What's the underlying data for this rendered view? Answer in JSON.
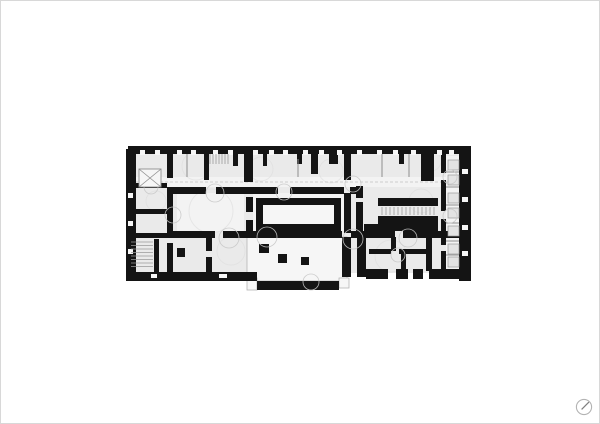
{
  "page": {
    "background": "#ffffff",
    "border_color": "#d8d8d8"
  },
  "compass_icon": {
    "ring_color": "#b3b3b3",
    "needle_color": "#7d7d7d"
  },
  "plan": {
    "colors": {
      "wall": "#141414",
      "base": "#eaeaea",
      "hall": "#f3f3f3",
      "cut": "#f6f6f6",
      "outline": "#b5b5b5",
      "partition": "#8f8f8f",
      "tread": "#9a9a9a",
      "fixture_fill": "#e3e3e3",
      "fixture_stroke": "#999999",
      "arc": "#c8c8c8",
      "texture": "#dcdcdc",
      "dash": "#c0c0c0"
    },
    "base_rects": [
      [
        133,
        152,
        327,
        120,
        "base"
      ],
      [
        133,
        176,
        327,
        10,
        "hall"
      ],
      [
        176,
        192,
        67,
        38,
        "hall"
      ],
      [
        252,
        192,
        92,
        38,
        "hall"
      ],
      [
        445,
        155,
        14,
        113,
        "hall"
      ]
    ],
    "outlined_rooms": [
      [
        246,
        236,
        100,
        44
      ],
      [
        246,
        277,
        10,
        12
      ],
      [
        338,
        277,
        10,
        10
      ]
    ],
    "walls": [
      [
        127,
        145,
        343,
        8
      ],
      [
        125,
        148,
        10,
        132
      ],
      [
        458,
        145,
        12,
        135
      ],
      [
        125,
        271,
        131,
        9
      ],
      [
        256,
        280,
        82,
        9
      ],
      [
        365,
        268,
        22,
        10
      ],
      [
        395,
        268,
        12,
        10
      ],
      [
        412,
        268,
        10,
        10
      ],
      [
        428,
        268,
        30,
        10
      ],
      [
        341,
        236,
        9,
        40
      ],
      [
        356,
        236,
        9,
        40
      ],
      [
        166,
        153,
        6,
        24
      ],
      [
        166,
        186,
        6,
        46
      ],
      [
        166,
        242,
        6,
        29
      ],
      [
        203,
        153,
        5,
        26
      ],
      [
        243,
        150,
        9,
        31
      ],
      [
        310,
        153,
        7,
        20
      ],
      [
        328,
        148,
        9,
        15
      ],
      [
        343,
        153,
        7,
        26
      ],
      [
        343,
        192,
        7,
        40
      ],
      [
        355,
        185,
        7,
        12
      ],
      [
        355,
        201,
        7,
        31
      ],
      [
        420,
        153,
        13,
        27
      ],
      [
        440,
        153,
        5,
        19
      ],
      [
        440,
        179,
        5,
        31
      ],
      [
        440,
        218,
        5,
        26
      ],
      [
        440,
        250,
        5,
        18
      ],
      [
        205,
        237,
        6,
        13
      ],
      [
        205,
        256,
        6,
        15
      ],
      [
        390,
        236,
        5,
        14
      ],
      [
        400,
        250,
        5,
        21
      ],
      [
        425,
        236,
        6,
        34
      ],
      [
        172,
        186,
        33,
        7
      ],
      [
        215,
        186,
        62,
        7
      ],
      [
        289,
        186,
        54,
        7
      ],
      [
        349,
        186,
        13,
        7
      ],
      [
        166,
        230,
        48,
        7
      ],
      [
        222,
        230,
        119,
        7
      ],
      [
        350,
        230,
        44,
        7
      ],
      [
        402,
        230,
        56,
        7
      ],
      [
        255,
        197,
        85,
        33
      ],
      [
        245,
        196,
        7,
        15
      ],
      [
        245,
        219,
        7,
        13
      ],
      [
        377,
        197,
        60,
        8
      ],
      [
        377,
        215,
        60,
        8
      ],
      [
        388,
        223,
        49,
        7
      ],
      [
        363,
        223,
        26,
        9
      ],
      [
        368,
        248,
        22,
        5
      ],
      [
        398,
        248,
        27,
        5
      ],
      [
        135,
        182,
        31,
        5
      ],
      [
        135,
        208,
        31,
        5
      ],
      [
        131,
        232,
        35,
        5
      ],
      [
        153,
        238,
        5,
        33
      ],
      [
        176,
        247,
        8,
        9
      ],
      [
        258,
        243,
        10,
        9
      ],
      [
        232,
        153,
        5,
        12
      ],
      [
        262,
        153,
        4,
        12
      ],
      [
        296,
        153,
        5,
        10
      ],
      [
        398,
        153,
        5,
        10
      ]
    ],
    "white_cuts": [
      [
        262,
        204,
        71,
        19
      ],
      [
        139,
        149,
        5,
        5
      ],
      [
        154,
        149,
        5,
        5
      ],
      [
        176,
        149,
        5,
        5
      ],
      [
        190,
        149,
        5,
        5
      ],
      [
        212,
        149,
        5,
        5
      ],
      [
        227,
        149,
        5,
        5
      ],
      [
        252,
        149,
        5,
        5
      ],
      [
        268,
        149,
        5,
        5
      ],
      [
        282,
        149,
        5,
        5
      ],
      [
        302,
        149,
        5,
        5
      ],
      [
        318,
        149,
        5,
        5
      ],
      [
        336,
        149,
        5,
        5
      ],
      [
        356,
        149,
        5,
        5
      ],
      [
        376,
        149,
        5,
        5
      ],
      [
        392,
        149,
        5,
        5
      ],
      [
        410,
        149,
        5,
        5
      ],
      [
        436,
        149,
        5,
        5
      ],
      [
        448,
        149,
        5,
        5
      ],
      [
        461,
        168,
        6,
        5
      ],
      [
        461,
        196,
        6,
        5
      ],
      [
        461,
        224,
        6,
        5
      ],
      [
        461,
        250,
        6,
        5
      ],
      [
        127,
        192,
        5,
        5
      ],
      [
        127,
        220,
        5,
        5
      ],
      [
        127,
        248,
        5,
        5
      ],
      [
        150,
        273,
        6,
        4
      ],
      [
        218,
        273,
        8,
        4
      ]
    ],
    "columns": [
      [
        277,
        253,
        9,
        9
      ],
      [
        300,
        256,
        8,
        8
      ]
    ],
    "partitions": [
      [
        445,
        171,
        458,
        171
      ],
      [
        445,
        186,
        458,
        186
      ],
      [
        445,
        204,
        458,
        204
      ],
      [
        445,
        222,
        458,
        222
      ],
      [
        445,
        240,
        458,
        240
      ],
      [
        445,
        254,
        458,
        254
      ],
      [
        186,
        153,
        186,
        176
      ],
      [
        297,
        158,
        297,
        176
      ],
      [
        381,
        153,
        381,
        176
      ],
      [
        408,
        153,
        408,
        176
      ]
    ],
    "treads": [
      [
        130,
        241,
        152,
        241
      ],
      [
        130,
        244.5,
        152,
        244.5
      ],
      [
        130,
        248,
        152,
        248
      ],
      [
        130,
        251.5,
        152,
        251.5
      ],
      [
        130,
        255,
        152,
        255
      ],
      [
        130,
        258.5,
        152,
        258.5
      ],
      [
        130,
        262,
        152,
        262
      ],
      [
        130,
        265.5,
        152,
        265.5
      ],
      [
        209,
        153,
        209,
        163
      ],
      [
        212,
        153,
        212,
        163
      ],
      [
        215,
        153,
        215,
        163
      ],
      [
        218,
        153,
        218,
        163
      ],
      [
        221,
        153,
        221,
        163
      ],
      [
        224,
        153,
        224,
        163
      ],
      [
        227,
        153,
        227,
        163
      ],
      [
        381,
        206,
        381,
        214
      ],
      [
        385,
        206,
        385,
        214
      ],
      [
        389,
        206,
        389,
        214
      ],
      [
        393,
        206,
        393,
        214
      ],
      [
        397,
        206,
        397,
        214
      ],
      [
        401,
        206,
        401,
        214
      ],
      [
        405,
        206,
        405,
        214
      ],
      [
        409,
        206,
        409,
        214
      ],
      [
        413,
        206,
        413,
        214
      ],
      [
        417,
        206,
        417,
        214
      ],
      [
        421,
        206,
        421,
        214
      ],
      [
        425,
        206,
        425,
        214
      ],
      [
        429,
        206,
        429,
        214
      ],
      [
        433,
        206,
        433,
        214
      ]
    ],
    "fixtures": [
      [
        447,
        159,
        11,
        10
      ],
      [
        447,
        174,
        11,
        10
      ],
      [
        447,
        192,
        11,
        10
      ],
      [
        447,
        207,
        11,
        10
      ],
      [
        447,
        225,
        11,
        10
      ],
      [
        447,
        243,
        11,
        10
      ],
      [
        447,
        256,
        11,
        10
      ]
    ],
    "door_arcs": [
      [
        214,
        192,
        9
      ],
      [
        283,
        191,
        8
      ],
      [
        172,
        214,
        8
      ],
      [
        228,
        237,
        10
      ],
      [
        266,
        236,
        10
      ],
      [
        352,
        238,
        10
      ],
      [
        407,
        237,
        9
      ],
      [
        449,
        176,
        7
      ],
      [
        449,
        215,
        7
      ],
      [
        352,
        183,
        8
      ],
      [
        310,
        281,
        8
      ],
      [
        150,
        186,
        7
      ],
      [
        397,
        254,
        7
      ]
    ],
    "texture_arcs": [
      [
        210,
        210,
        22
      ],
      [
        300,
        214,
        16
      ],
      [
        195,
        165,
        14
      ],
      [
        260,
        168,
        12
      ],
      [
        330,
        170,
        12
      ],
      [
        300,
        255,
        20
      ],
      [
        315,
        250,
        14
      ],
      [
        390,
        255,
        16
      ],
      [
        420,
        200,
        12
      ],
      [
        155,
        200,
        10
      ],
      [
        230,
        250,
        14
      ],
      [
        430,
        160,
        10
      ]
    ],
    "shaft": {
      "rect": [
        138,
        168,
        22,
        18
      ]
    },
    "corridor_dash": [
      134,
      181,
      458,
      181
    ]
  }
}
